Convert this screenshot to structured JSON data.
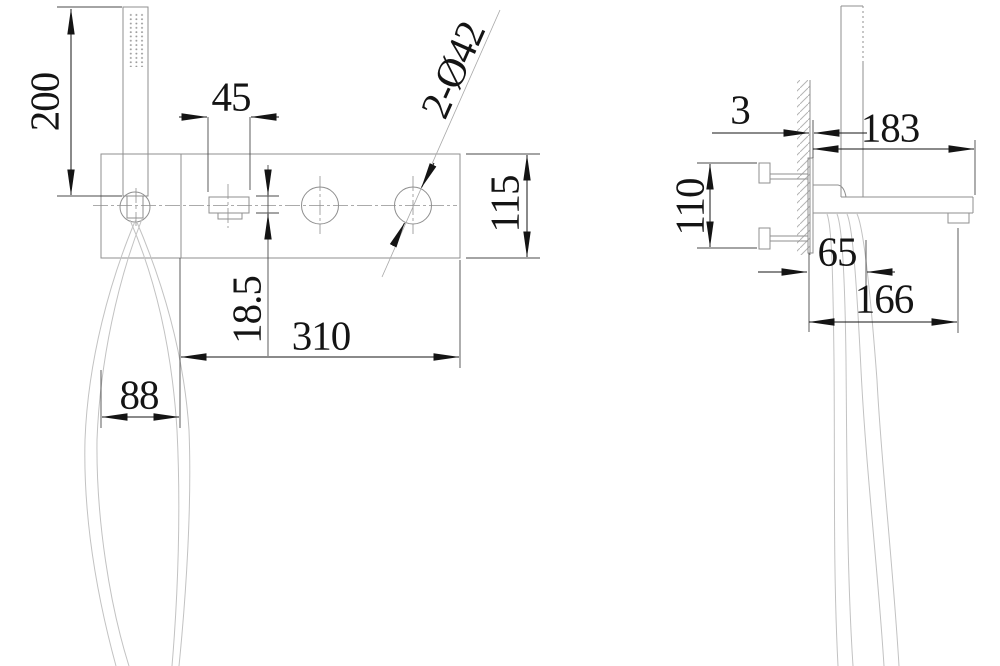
{
  "drawing_type": "technical dimension drawing, wall-mounted bath mixer with hand shower, front and side views",
  "front_view": {
    "dim_shower_height": "200",
    "dim_handle_width": "45",
    "dim_holes": "2-Ø42",
    "dim_plate_height": "115",
    "dim_handle_height": "18.5",
    "dim_plate_width": "310",
    "dim_holder_offset": "88"
  },
  "side_view": {
    "dim_plate_thickness": "3",
    "dim_reach": "183",
    "dim_mounting_height": "110",
    "dim_shower_offset": "65",
    "dim_spout_projection": "166"
  },
  "colors": {
    "background": "#ffffff",
    "geometry_line": "#8f8f8f",
    "dimension_line": "#141414",
    "extension_line": "#4a4a4a",
    "hose_line": "#c2c2c2"
  }
}
